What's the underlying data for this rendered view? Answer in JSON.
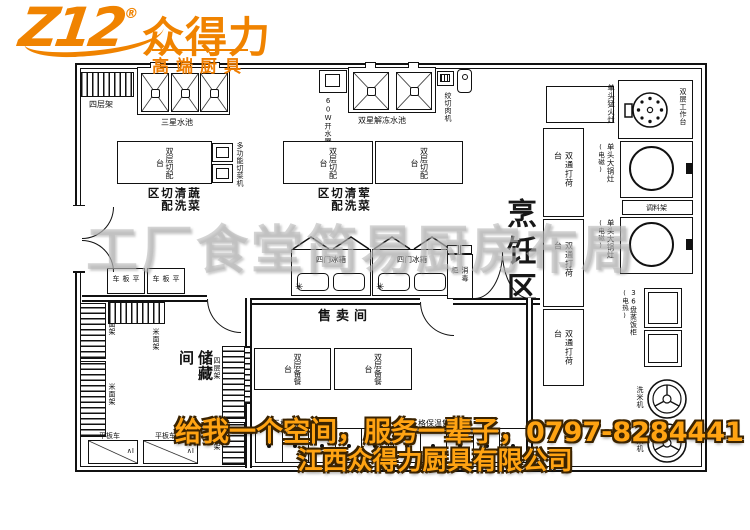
{
  "logo": {
    "mark": "Z12",
    "registered": "®",
    "brand": "众得力",
    "tagline": "高端厨具"
  },
  "watermark": "工厂食堂简易厨房布局",
  "footer": {
    "slogan": "给我一个空间，服务一辈子，0797-8284441",
    "company": "江西众得力厨具有限公司"
  },
  "colors": {
    "brand_orange": "#f08300",
    "slogan_orange": "#ffa312",
    "watermark_gray": "#bababa",
    "line_black": "#111111"
  },
  "areas": {
    "vegetable": "蔬菜清洗切配区",
    "meat": "荤菜清洗切配区",
    "cooking": "烹饪区",
    "sales": "售卖间",
    "storage": "储藏间"
  },
  "equipment": {
    "tier_shelf": "四层架",
    "triple_sink": "三星水池",
    "water_boiler": "60W开水器",
    "double_sink": "双星解冻水池",
    "meat_grinder": "绞切肉机",
    "work_table": "双层工作台",
    "fierce_stove": "单头猛火灶",
    "big_wok_stove": "单头大锅灶",
    "big_wok_stove_note": "(电磁)",
    "spice_rack": "调料架",
    "rice_steamer": "36盘蒸饭柜",
    "rice_steamer_note": "(电热)",
    "rice_washer": "洗米机",
    "pass_counter": "双通打荷台",
    "cutting_table": "双层切配台",
    "veg_cutting_machine": "多功能切菜机",
    "four_door_fridge": "四门冰箱",
    "freeze_symbol": "✳",
    "serving_prep_table": "双层备餐台",
    "hot_serving_counter": "五格保温售饭台",
    "rice_flour_rack": "米面架",
    "flat_cart": "平板车",
    "disinfect_cabinet": "消毒柜",
    "cart_mark": "∧I"
  }
}
